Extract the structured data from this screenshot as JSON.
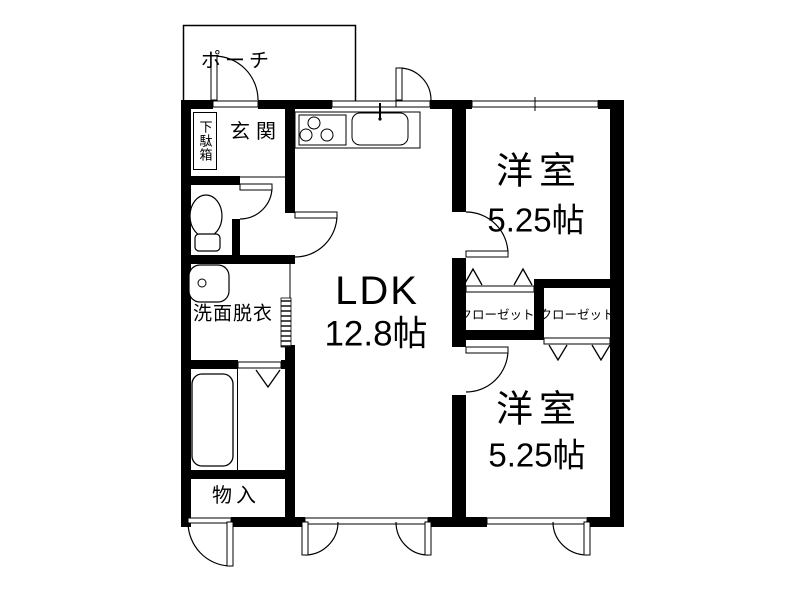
{
  "floorplan": {
    "background": "#ffffff",
    "line_color": "#000000",
    "rooms": {
      "porch": {
        "label": "ポーチ"
      },
      "entrance": {
        "label": "玄関"
      },
      "shoe_cabinet": {
        "label": "下駄箱"
      },
      "washroom": {
        "label": "洗面脱衣"
      },
      "storage": {
        "label": "物入"
      },
      "ldk": {
        "label": "LDK",
        "size": "12.8帖"
      },
      "bedroom_top": {
        "label": "洋室",
        "size": "5.25帖"
      },
      "bedroom_bottom": {
        "label": "洋室",
        "size": "5.25帖"
      },
      "closet_left": {
        "label": "クローゼット"
      },
      "closet_right": {
        "label": "クローゼット"
      }
    },
    "fixtures": [
      "toilet-icon",
      "washbasin-icon",
      "bathtub-icon",
      "gas-stove-icon",
      "kitchen-sink-icon"
    ]
  }
}
